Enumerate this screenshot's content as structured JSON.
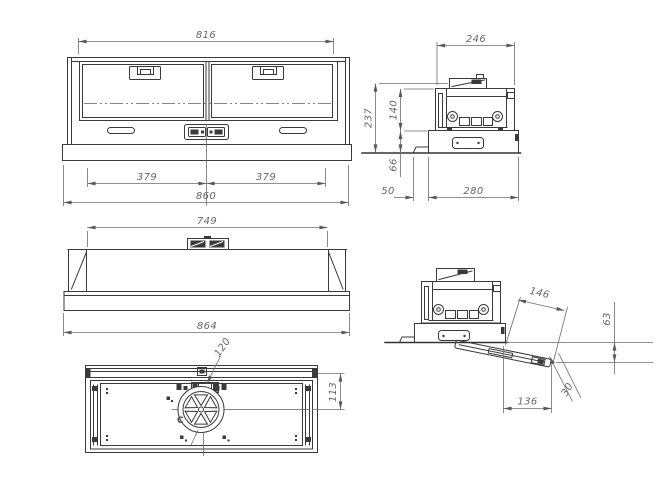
{
  "colors": {
    "object_line": "#3a3a3a",
    "dimension_line": "#6d6d6d",
    "dimension_text": "#676767",
    "background": "#ffffff"
  },
  "views": {
    "front_closed": {
      "dims": {
        "top_width": "816",
        "left_duct_offset": "379",
        "right_duct_offset": "379",
        "body_width": "860"
      }
    },
    "side_closed": {
      "dims": {
        "top_depth": "246",
        "total_height": "237",
        "upper_height": "140",
        "plinth_height": "66",
        "front_offset": "50",
        "bottom_depth": "280"
      }
    },
    "front_open": {
      "dims": {
        "inner_width": "749",
        "overall_width": "864"
      }
    },
    "bottom_view": {
      "dims": {
        "outlet_diameter": "120",
        "outlet_center_offset": "113"
      },
      "center_mark": "C"
    },
    "side_open": {
      "dims": {
        "visor_length": "146",
        "visor_drop": "63",
        "visor_angle": "30",
        "visor_projection": "136"
      }
    }
  }
}
